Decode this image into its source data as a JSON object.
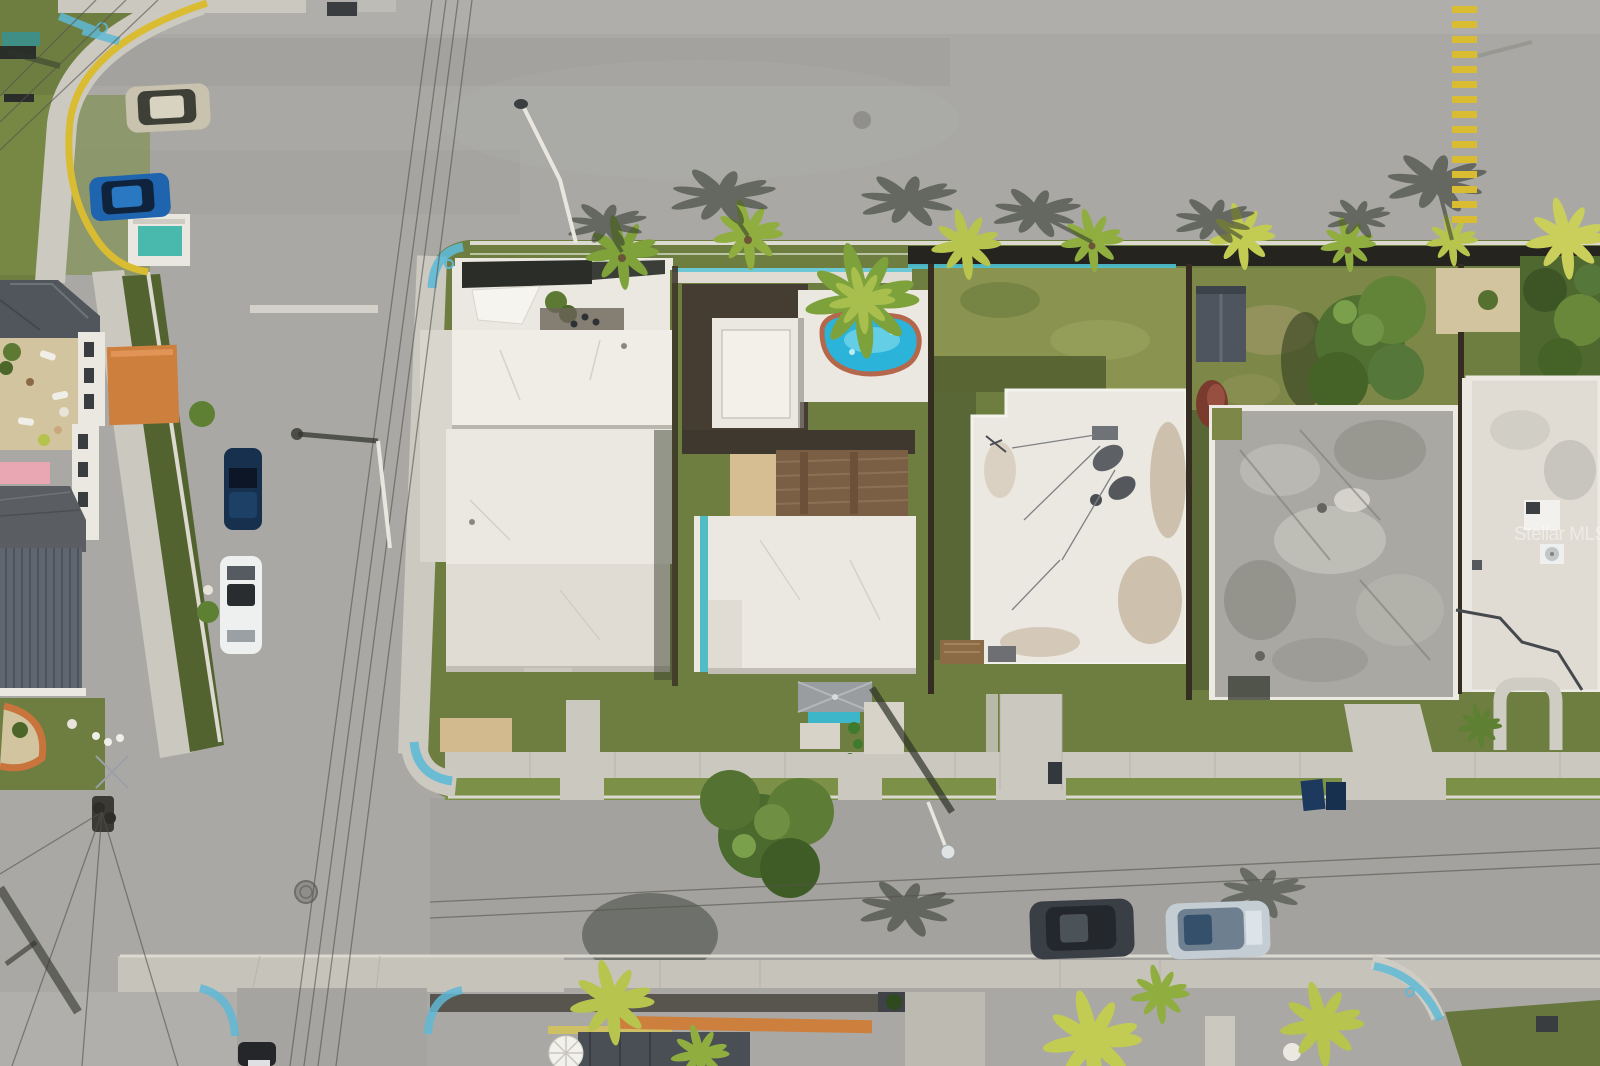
{
  "watermark": {
    "text": "Stellar MLS"
  },
  "palette": {
    "asphalt": "#a9a8a4",
    "asphalt_dark": "#9c9b97",
    "concrete": "#cbc8c0",
    "concrete_bright": "#dcd9d1",
    "grass": "#6e7e40",
    "grass_bright": "#7c9048",
    "grass_dark": "#4c5a2d",
    "grass_pale": "#8a9450",
    "turf": "#53632f",
    "roof_white": "#ebe8e1",
    "roof_cream": "#e0dcd4",
    "roof_gray": "#a9a8a2",
    "roof_slate": "#565c64",
    "pool_water": "#2cb3da",
    "pool_rim": "#b4674a",
    "deck_wood": "#7a5f45",
    "deck_orange": "#cd7f3e",
    "teal": "#4fc3d4",
    "yellow": "#d9bc31",
    "blue_paint": "#5fb9d6",
    "shadow": "#2f352c",
    "palm": "#8fae3f",
    "palm_yellow": "#c2cb52",
    "tree": "#4f7030",
    "car_beige": "#c9c2ae",
    "car_blue": "#1f64ae",
    "car_navy": "#16304d",
    "car_white": "#eef0ef",
    "car_silver": "#c3cdd3",
    "car_dark": "#3a3f46",
    "wall_dark": "#26241f",
    "sand": "#d2c49e",
    "wire": "#55524c",
    "watermark": "#ffffff"
  }
}
